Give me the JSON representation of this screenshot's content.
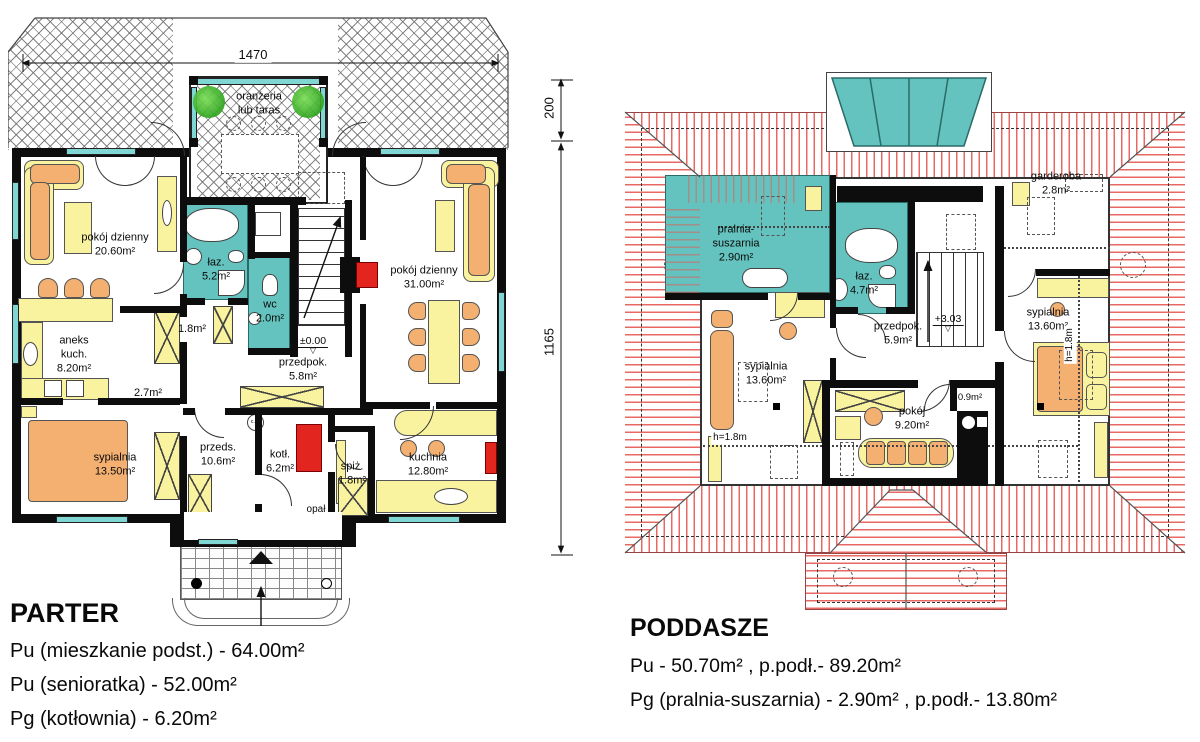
{
  "colors": {
    "wall": "#0d0d0d",
    "bathroom_teal": "#64c3be",
    "window_teal": "#7fd6d2",
    "furniture_yellow": "#f9f3a0",
    "furniture_orange": "#f3b070",
    "accent_red": "#e2251f",
    "roof_hatch_red": "#e65852",
    "roof_hatch_gray": "#6e6e6e",
    "plant_green": "#2fa31f"
  },
  "parter": {
    "title": "PARTER",
    "legend": [
      "Pu (mieszkanie podst.) - 64.00m²",
      "Pu (senioratka) - 52.00m²",
      "Pg (kotłownia) - 6.20m²"
    ],
    "dims": {
      "top": "1470",
      "right_upper": "200",
      "right_lower": "1165"
    },
    "level": {
      "value": "±0.00",
      "marker": "▽"
    },
    "rooms": {
      "oranzeria": {
        "l1": "oranżeria",
        "l2": "lub taras"
      },
      "pokoj1": {
        "name": "pokój dzienny",
        "area": "20.60m²"
      },
      "laz": {
        "name": "łaz.",
        "area": "5.2m²"
      },
      "wc": {
        "name": "wc",
        "area": "2.0m²"
      },
      "pokoj2": {
        "name": "pokój dzienny",
        "area": "31.00m²"
      },
      "aneks": {
        "l1": "aneks",
        "l2": "kuch.",
        "area": "8.20m²"
      },
      "sypialnia": {
        "name": "sypialnia",
        "area": "13.50m²"
      },
      "przedpok": {
        "name": "przedpok.",
        "area": "5.8m²"
      },
      "przeds": {
        "name": "przeds.",
        "area": "10.6m²"
      },
      "kotl": {
        "name": "kotł.",
        "area": "6.2m²"
      },
      "spiz": {
        "name": "spiż.",
        "area": "1.8m²"
      },
      "kuchnia": {
        "name": "kuchnia",
        "area": "12.80m²"
      },
      "closet_a": "1.8m²",
      "closet_b": "2.7m²",
      "opal": "opał",
      "cw": "c.w."
    }
  },
  "poddasze": {
    "title": "PODDASZE",
    "legend": [
      "Pu - 50.70m² ,  p.podł.- 89.20m²",
      "Pg (pralnia-suszarnia) - 2.90m² ,  p.podł.- 13.80m²"
    ],
    "level": {
      "value": "+3.03",
      "marker": "▽"
    },
    "rooms": {
      "pralnia": {
        "l1": "pralnia-",
        "l2": "suszarnia",
        "area": "2.90m²"
      },
      "laz": {
        "name": "łaz.",
        "area": "4.7m²"
      },
      "garderoba": {
        "name": "garderoba",
        "area": "2.8m²"
      },
      "przedpok": {
        "name": "przedpok.",
        "area": "5.9m²"
      },
      "sypialnia_l": {
        "name": "sypialnia",
        "area": "13.60m²"
      },
      "sypialnia_r": {
        "name": "sypialnia",
        "area": "13.60m²"
      },
      "pokoj": {
        "name": "pokój",
        "area": "9.20m²"
      },
      "closet": "0.9m²",
      "h_left": "h=1.8m",
      "h_right": "h=1.8m"
    }
  }
}
